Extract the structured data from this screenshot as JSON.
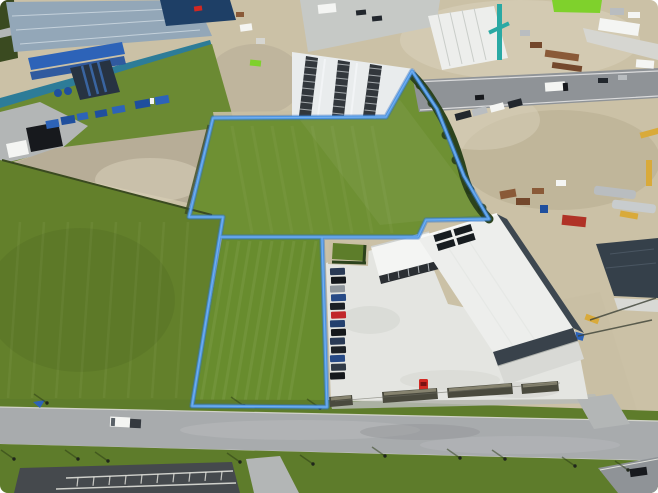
{
  "meta": {
    "title": "Aerial drone photograph of an industrial estate with vacant grass parcels outlined in blue",
    "width_px": 658,
    "height_px": 493,
    "visible_text": "none"
  },
  "overlay": {
    "boundary_color": "#4a94e4",
    "boundary_glow_color": "#2f6fc0",
    "boundary_core_color": "#79b4f0",
    "boundary_line_width_px": 3,
    "shape": "irregular polygon outlining two grass paddocks and the warehouse frontage"
  },
  "colors": {
    "base": "#cbc1a6",
    "gravel1": "#c9bfa4",
    "gravel2": "#d8d0ba",
    "sandShadow": "#b3a88c",
    "dirt": "#b7ad97",
    "fieldL": "#63802b",
    "fieldC": "#6e9033",
    "fieldLow": "#688c2e",
    "bank": "#6b8a33",
    "verge": "#5e7c2b",
    "greenSq": "#5d7d2a",
    "roadA": "#a8abad",
    "roadB": "#8f9397",
    "roadC": "#b3b6b6",
    "paving": "#c6c9c6",
    "asphalt": "#45494d",
    "lotMark": "#e8e8e2",
    "concrete": "#d8d9d5",
    "apron": "#e4e5e1",
    "roofWhite": "#edeeec",
    "canopy": "#e9eced",
    "fascia": "#39424b",
    "shadowSide": "#3d4750",
    "roofTL": "#93a7b8",
    "tealWall": "#2d7c98",
    "containerNavy": "#1e3f66",
    "navyBox": "#273342",
    "blue1": "#2d63b8",
    "blue2": "#1f4f9e",
    "hedge": "#2c431c",
    "hedgeDark": "#243a17",
    "fence": "#3a4a20",
    "carDark": "#22272d",
    "ink": "#17191d",
    "lime": "#7fd12c",
    "tealCrane": "#2aa9a4",
    "yellow": "#d9aa3a",
    "rust": "#8a5a38",
    "rustDark": "#74482c",
    "red": "#d22822",
    "redBox": "#b03226",
    "silver": "#b9bdc0",
    "white": "#f4f5f3",
    "lightBldg": "#d6d6d1",
    "navyRoof": "#35404a",
    "glazing": "#2b2f33",
    "panel": "#171c20",
    "planter": "#4a4a3e",
    "planterTop": "#8d8a74"
  },
  "scene": {
    "regions": [
      {
        "name": "industrial-depot-northwest",
        "description": "blue-grey warehouse roofs, teal wall, blue containers and trucks in a dirt yard"
      },
      {
        "name": "grass-bank-northwest",
        "description": "green embankment between depot wall and yard"
      },
      {
        "name": "car-storage-canopy",
        "description": "white canopies with rows of dark parked cars, top centre"
      },
      {
        "name": "construction-yard-northeast",
        "description": "sandy yard with cranes, rusty plant, tankers, containers and sheds"
      },
      {
        "name": "upper-access-road",
        "description": "grey road with truck and cars running across the top right"
      },
      {
        "name": "central-grass-parcel",
        "description": "large outlined vacant grass field"
      },
      {
        "name": "lower-left-grass-parcel",
        "description": "second outlined grass strip beside the road"
      },
      {
        "name": "left-grass-field",
        "description": "large paddock outside the boundary with mowing stripes"
      },
      {
        "name": "main-warehouse",
        "description": "white-roofed warehouse with solar panels, dark fascia and glazed office"
      },
      {
        "name": "staff-car-park-row",
        "description": "single column of parked cars including one red car"
      },
      {
        "name": "red-car-at-entrance",
        "description": "bright red car on the concrete apron"
      },
      {
        "name": "front-planters",
        "description": "low dark planter strips along the warehouse frontage"
      },
      {
        "name": "main-road-bottom",
        "description": "wide grey road with white van, kerbs and street lights"
      },
      {
        "name": "parking-lot-southwest",
        "description": "dark asphalt car park with white bay markings"
      },
      {
        "name": "east-neighbour-building",
        "description": "dark navy roof building and gravel lane with yellow and blue plant"
      },
      {
        "name": "boundary-hedge",
        "description": "dark green hedge along the north-east boundary"
      }
    ],
    "car_row": {
      "count": 13,
      "colors": [
        "#2a3a55",
        "#15181c",
        "#8f969c",
        "#274a86",
        "#1b1f24",
        "#c1272a",
        "#23406e",
        "#15181c",
        "#2a3a55",
        "#1d2126",
        "#274a86",
        "#303a46",
        "#15181c"
      ]
    },
    "road_vehicles": {
      "white_van_with_dark_trailer": 1,
      "white_truck_upper_road": 1,
      "dark_car_bottom_right": 1
    }
  }
}
